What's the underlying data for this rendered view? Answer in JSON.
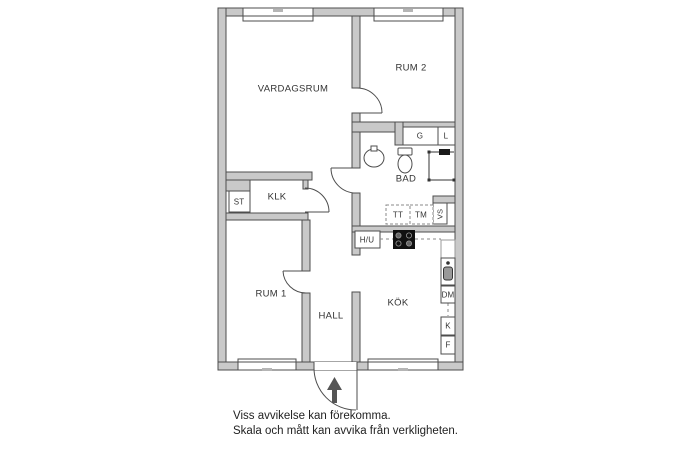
{
  "floor_plan": {
    "rooms": {
      "vardagsrum": "VARDAGSRUM",
      "rum2": "RUM 2",
      "bad": "BAD",
      "klk": "KLK",
      "rum1": "RUM 1",
      "hall": "HALL",
      "kok": "KÖK"
    },
    "storage": {
      "st": "ST",
      "g": "G",
      "l": "L"
    },
    "appliances": {
      "tt": "TT",
      "tm": "TM",
      "vs": "VS",
      "hu": "H/U",
      "dm": "DM",
      "k": "K",
      "f": "F"
    },
    "colors": {
      "wall_fill": "#c9c9c9",
      "wall_line": "#4d4d4d",
      "text": "#333333",
      "stove": "#111111",
      "entrance_arrow": "#555555"
    },
    "icons": [
      "entrance-arrow-icon",
      "sink-icon",
      "toilet-icon",
      "shower-icon",
      "stove-icon",
      "kitchen-sink-icon"
    ]
  },
  "disclaimer": {
    "line1": "Viss avvikelse kan förekomma.",
    "line2": "Skala och mått kan avvika från verkligheten."
  }
}
